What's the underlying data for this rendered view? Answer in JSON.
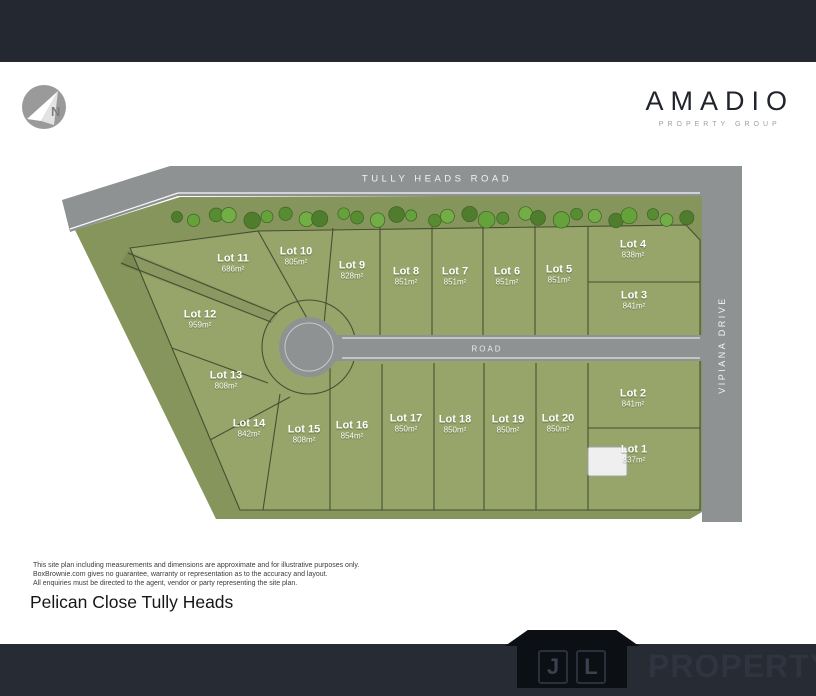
{
  "colors": {
    "top_bar": "#232831",
    "footer_bar": "#262b34",
    "road_gray": "#8f9293",
    "estate_green": "#85955b",
    "lot_green": "#97a46a",
    "boundary_line": "#39422a",
    "brand_dark": "#20242c"
  },
  "header": {
    "brand": "AMADIO",
    "brand_tagline": "PROPERTY GROUP"
  },
  "north_arrow": {
    "label": "N"
  },
  "plan": {
    "road_labels": {
      "top": "TULLY HEADS ROAD",
      "middle": "ROAD",
      "right": "VIPIANA DRIVE"
    },
    "lots": [
      {
        "name": "Lot 11",
        "area": "686m²",
        "x": 233,
        "y": 264
      },
      {
        "name": "Lot 10",
        "area": "805m²",
        "x": 296,
        "y": 257
      },
      {
        "name": "Lot 9",
        "area": "828m²",
        "x": 352,
        "y": 271
      },
      {
        "name": "Lot 8",
        "area": "851m²",
        "x": 406,
        "y": 277
      },
      {
        "name": "Lot 7",
        "area": "851m²",
        "x": 455,
        "y": 277
      },
      {
        "name": "Lot 6",
        "area": "851m²",
        "x": 507,
        "y": 277
      },
      {
        "name": "Lot 5",
        "area": "851m²",
        "x": 559,
        "y": 275
      },
      {
        "name": "Lot 4",
        "area": "838m²",
        "x": 633,
        "y": 250
      },
      {
        "name": "Lot 3",
        "area": "841m²",
        "x": 634,
        "y": 301
      },
      {
        "name": "Lot 12",
        "area": "959m²",
        "x": 200,
        "y": 320
      },
      {
        "name": "Lot 13",
        "area": "808m²",
        "x": 226,
        "y": 381
      },
      {
        "name": "Lot 14",
        "area": "842m²",
        "x": 249,
        "y": 429
      },
      {
        "name": "Lot 15",
        "area": "808m²",
        "x": 304,
        "y": 435
      },
      {
        "name": "Lot 16",
        "area": "854m²",
        "x": 352,
        "y": 431
      },
      {
        "name": "Lot 17",
        "area": "850m²",
        "x": 406,
        "y": 424
      },
      {
        "name": "Lot 18",
        "area": "850m²",
        "x": 455,
        "y": 425
      },
      {
        "name": "Lot 19",
        "area": "850m²",
        "x": 508,
        "y": 425
      },
      {
        "name": "Lot 20",
        "area": "850m²",
        "x": 558,
        "y": 424
      },
      {
        "name": "Lot 2",
        "area": "841m²",
        "x": 633,
        "y": 399
      },
      {
        "name": "Lot 1",
        "area": "837m²",
        "x": 634,
        "y": 455
      }
    ]
  },
  "disclaimer": {
    "line1": "This site plan including measurements and dimensions are approximate and for illustrative purposes only.",
    "line2": "BoxBrownie.com gives no guarantee, warranty or representation as to the accuracy and layout.",
    "line3": "All enquiries must be directed to the agent, vendor or party representing the site plan."
  },
  "title": "Pelican Close Tully Heads",
  "footer": {
    "logo_letters": [
      "J",
      "L"
    ],
    "logo_label": "PROPERTY"
  }
}
